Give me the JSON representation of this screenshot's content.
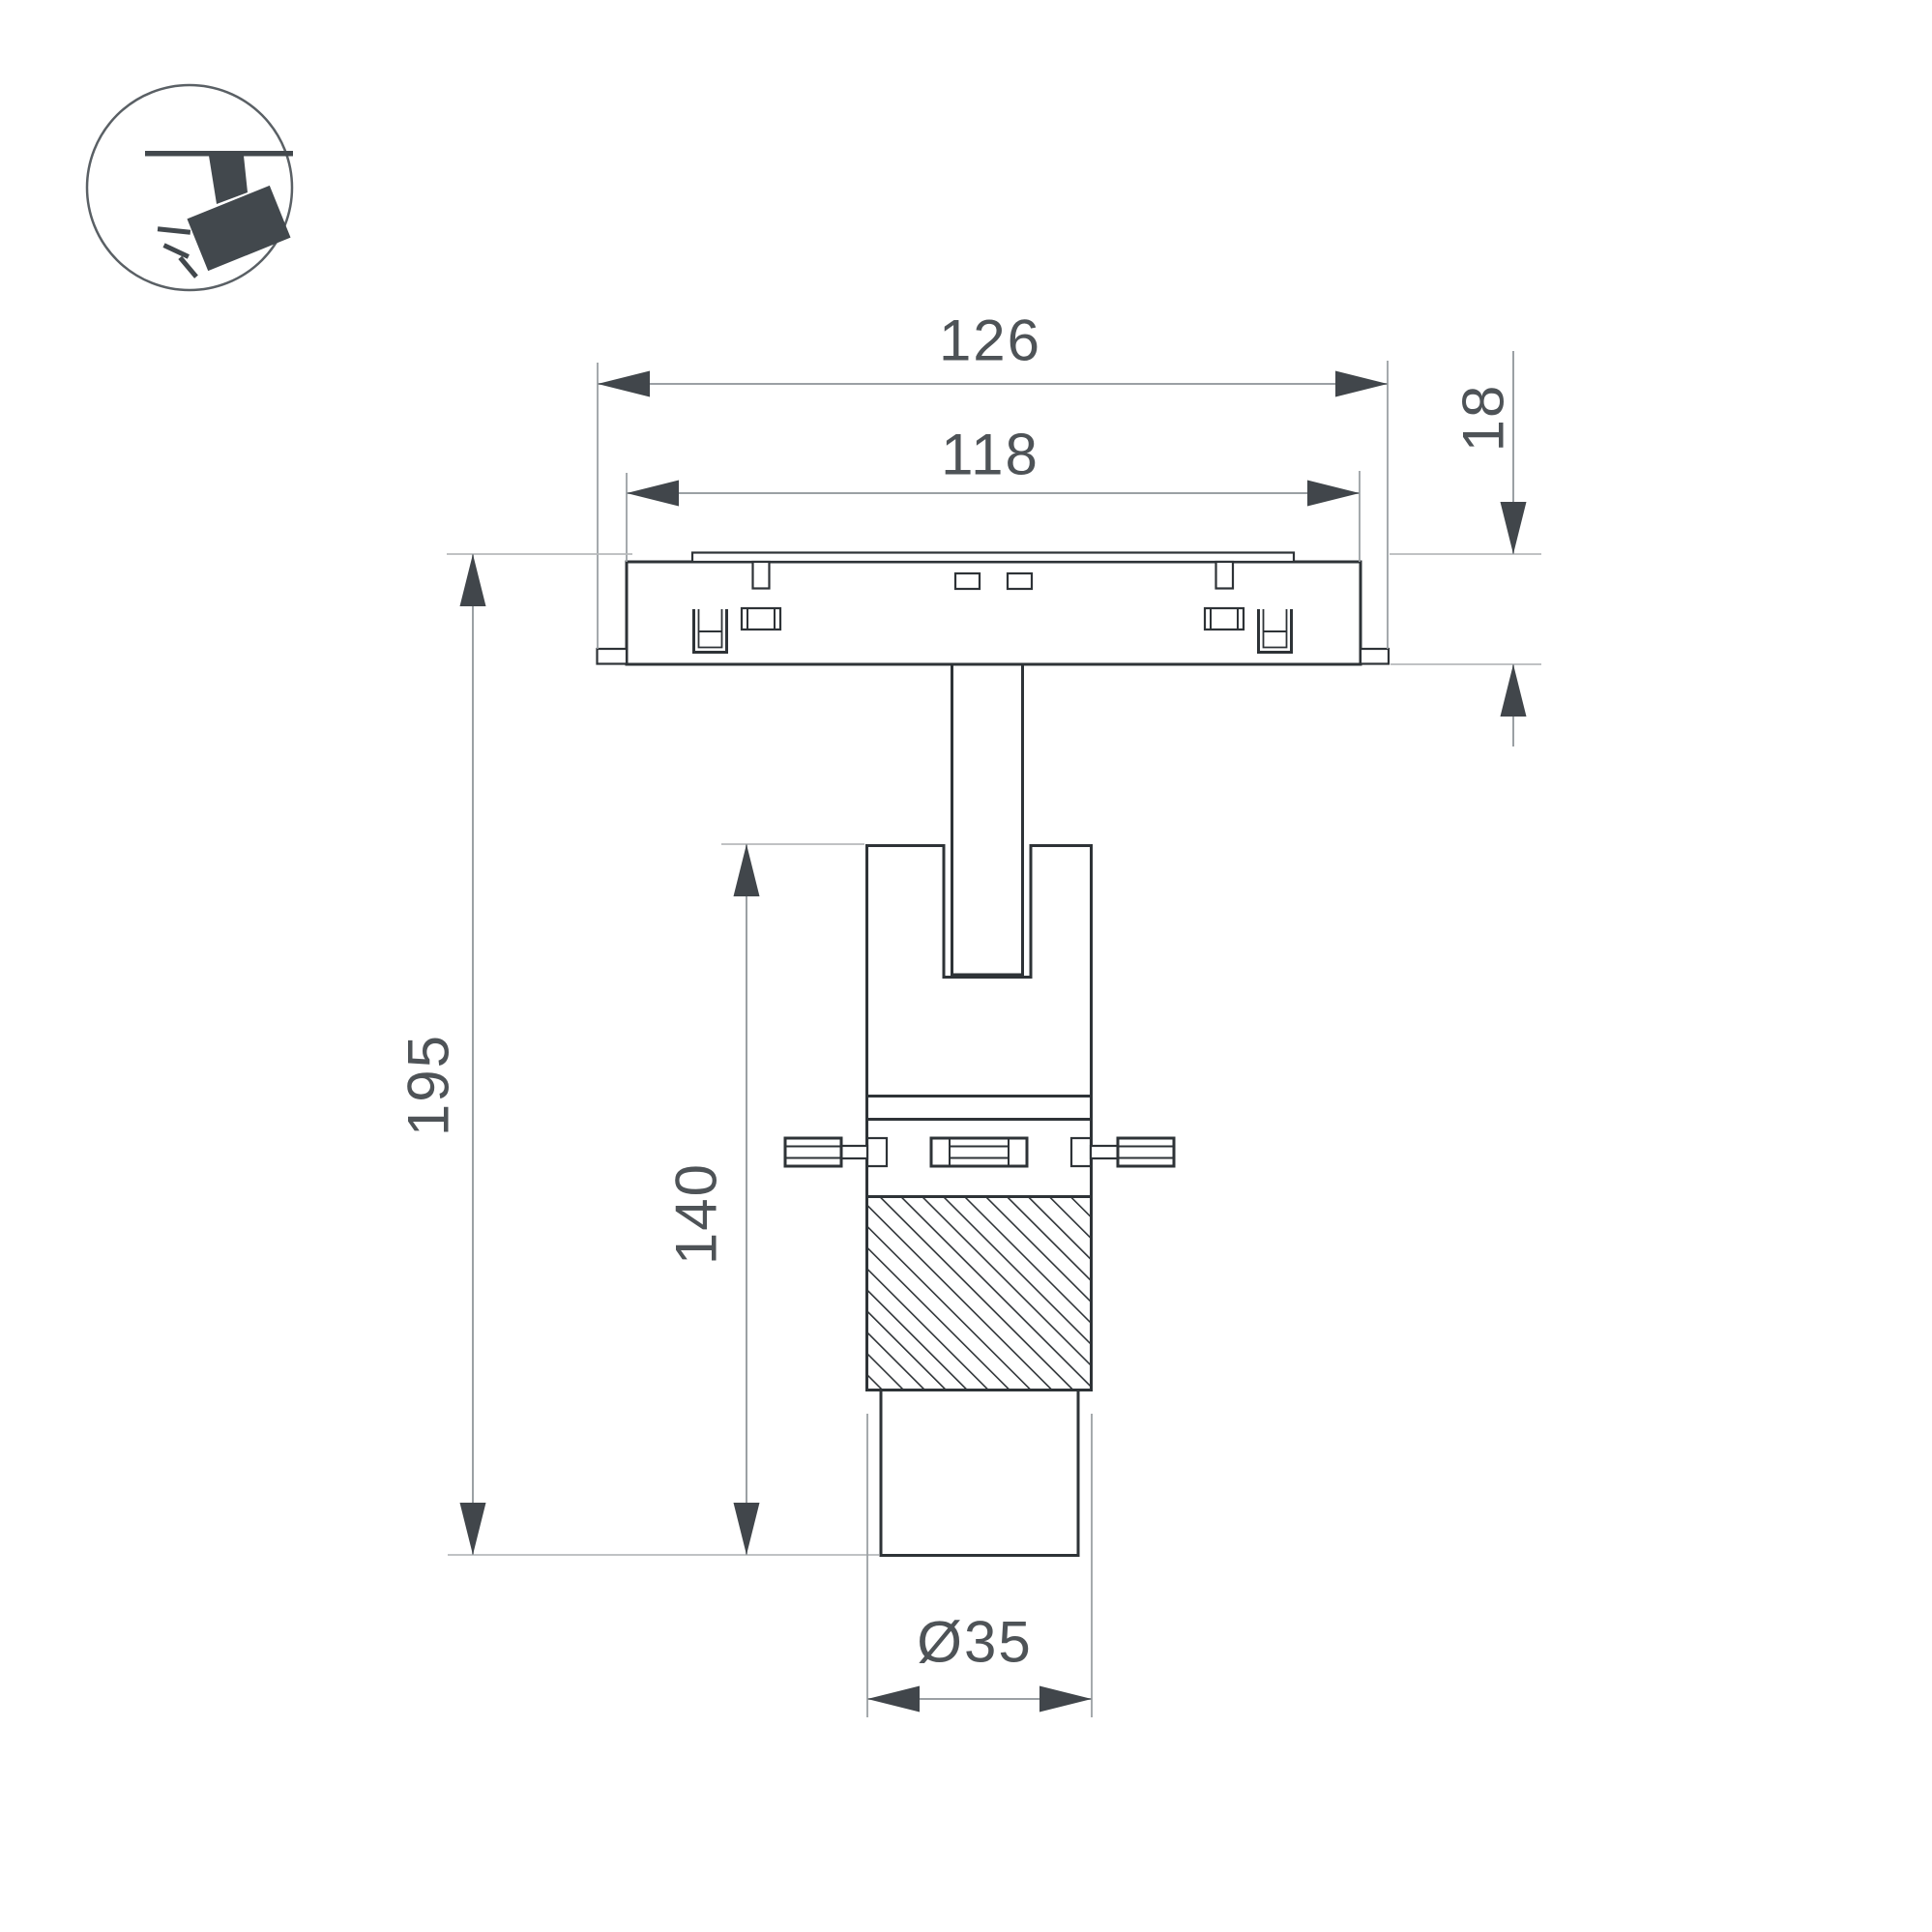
{
  "icon": {
    "name": "ceiling-track-spotlight-icon"
  },
  "dimensions": {
    "outer_width": "126",
    "inner_width": "118",
    "track_depth": "18",
    "overall_height": "195",
    "body_height": "140",
    "lens_diameter": "Ø35"
  },
  "colors": {
    "outline": "#2e3337",
    "dimension_line": "#9ba0a4",
    "datum_line": "#b7babc",
    "arrow": "#41464b",
    "text": "#4e5357",
    "icon": "#42484d",
    "background": "#ffffff"
  }
}
